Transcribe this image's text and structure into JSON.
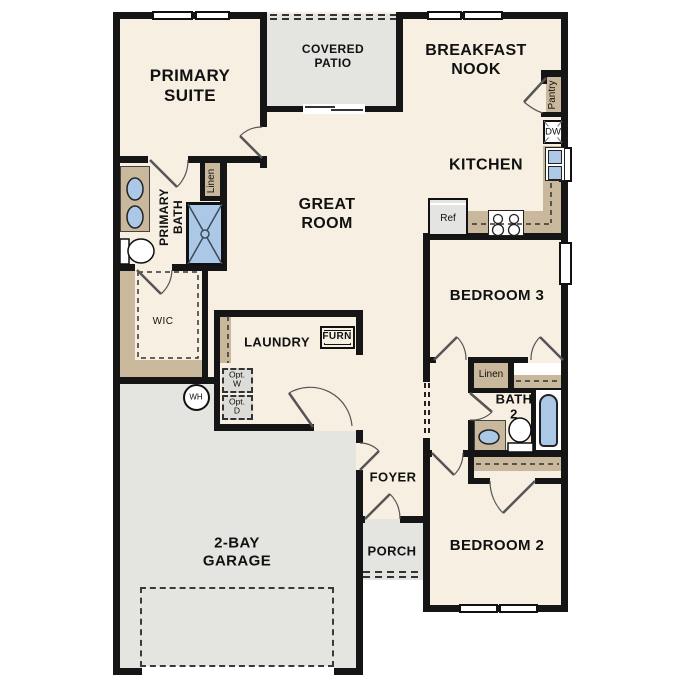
{
  "plan_title": "single-story floor plan",
  "colors": {
    "floor": "#f6efe2",
    "hard_surface": "#e4e4e1",
    "cabinet_tan": "#c9b89b",
    "fixture_blue": "#abc8e6",
    "wall": "#151515",
    "optional_item_fill": "#dcdcd8"
  },
  "rooms": {
    "primary_suite": "PRIMARY\nSUITE",
    "covered_patio": "COVERED\nPATIO",
    "breakfast_nook": "BREAKFAST\nNOOK",
    "kitchen": "KITCHEN",
    "great_room": "GREAT\nROOM",
    "primary_bath": "PRIMARY\nBATH",
    "laundry": "LAUNDRY",
    "bedroom3": "BEDROOM 3",
    "bath2": "BATH\n2",
    "bedroom2": "BEDROOM 2",
    "foyer": "FOYER",
    "porch": "PORCH",
    "garage": "2-BAY\nGARAGE"
  },
  "closets": {
    "wic": "WIC",
    "linen_primary": "Linen",
    "linen_hall": "Linen",
    "pantry": "Pantry"
  },
  "fixtures": {
    "dishwasher": "DW",
    "refrigerator": "Ref",
    "furnace": "FURN",
    "water_heater": "WH",
    "optional_washer": "Opt.\nW",
    "optional_dryer": "Opt.\nD"
  }
}
